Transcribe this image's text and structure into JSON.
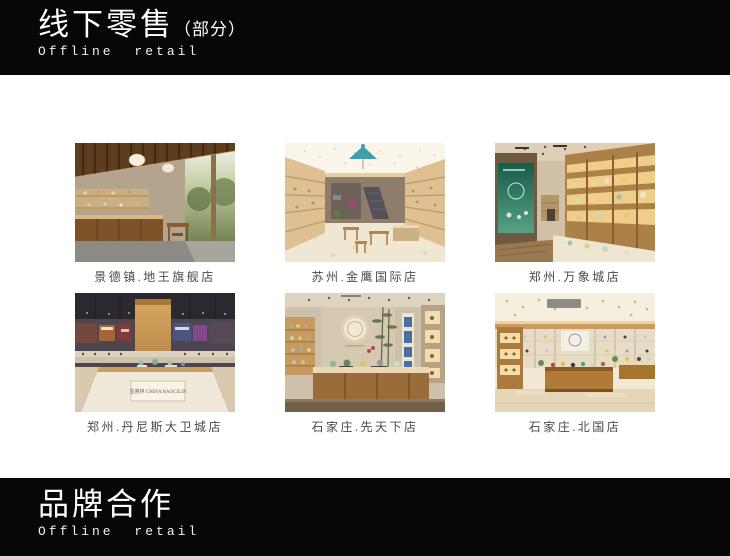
{
  "header": {
    "title_zh": "线下零售",
    "title_suffix": "（部分）",
    "subtitle_en": "Offline retail"
  },
  "footer": {
    "title_zh": "品牌合作",
    "subtitle_en": "Offline retail"
  },
  "stores": [
    {
      "caption": "景德镇.地王旗舰店"
    },
    {
      "caption": "苏州.金鹰国际店"
    },
    {
      "caption": "郑州.万象城店"
    },
    {
      "caption": "郑州.丹尼斯大卫城店",
      "sign_text": "宝瓷林 CHINA BAOCILIN"
    },
    {
      "caption": "石家庄.先天下店"
    },
    {
      "caption": "石家庄.北国店"
    }
  ],
  "colors": {
    "bar_background": "#070707",
    "bar_text": "#ffffff",
    "caption_text": "#4a4a4a",
    "page_background": "#ffffff"
  }
}
